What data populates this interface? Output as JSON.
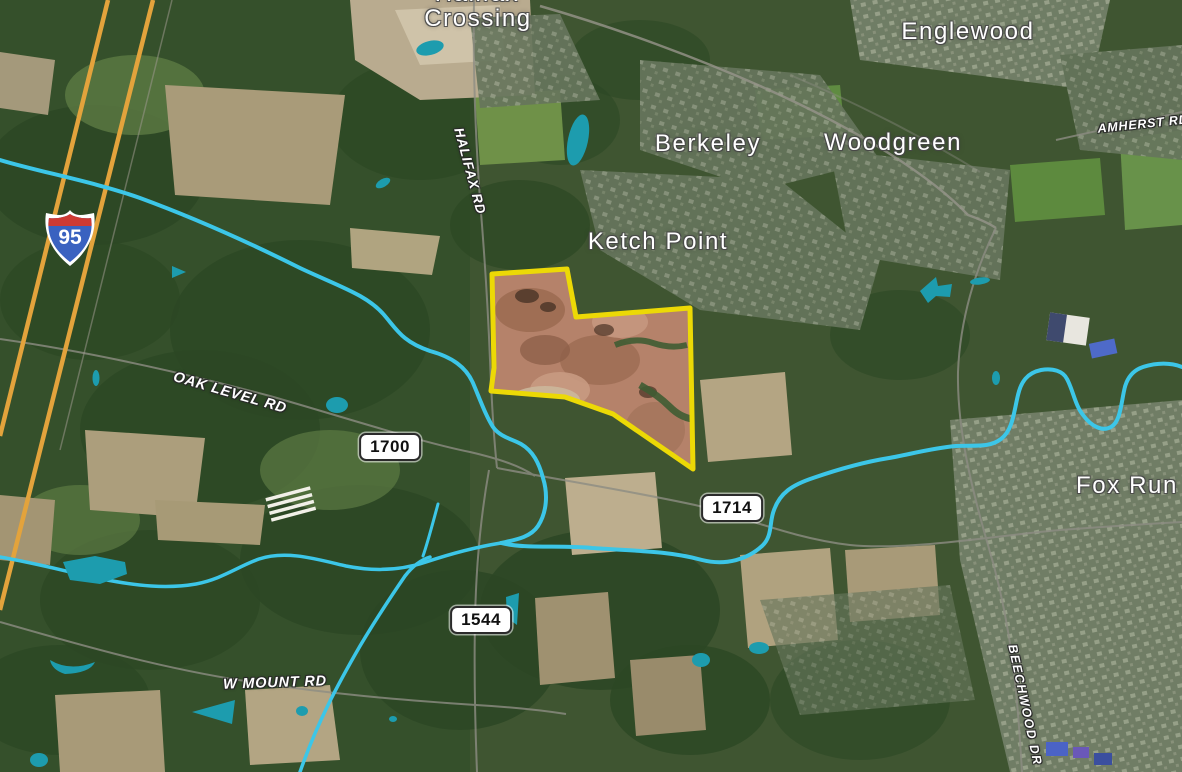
{
  "map": {
    "places": [
      {
        "name": "Halifax Crossing",
        "line1": "Halifax",
        "line2": "Crossing"
      },
      {
        "text": "Englewood"
      },
      {
        "text": "Berkeley"
      },
      {
        "text": "Woodgreen"
      },
      {
        "text": "Ketch Point"
      },
      {
        "text": "Fox Run"
      }
    ],
    "roads": [
      {
        "text": "HALIFAX RD"
      },
      {
        "text": "OAK LEVEL RD"
      },
      {
        "text": "W MOUNT RD"
      },
      {
        "text": "AMHERST RD"
      },
      {
        "text": "BEECHWOOD DR"
      }
    ],
    "badges": {
      "interstate": "95",
      "r1700": "1700",
      "r1714": "1714",
      "r1544": "1544"
    },
    "colors": {
      "water": "#3cc6e8",
      "pond": "#1d9cae",
      "highway": "#e3a33c",
      "parcel_outline": "#ecd906",
      "parcel_fill": "#b5826a"
    }
  }
}
